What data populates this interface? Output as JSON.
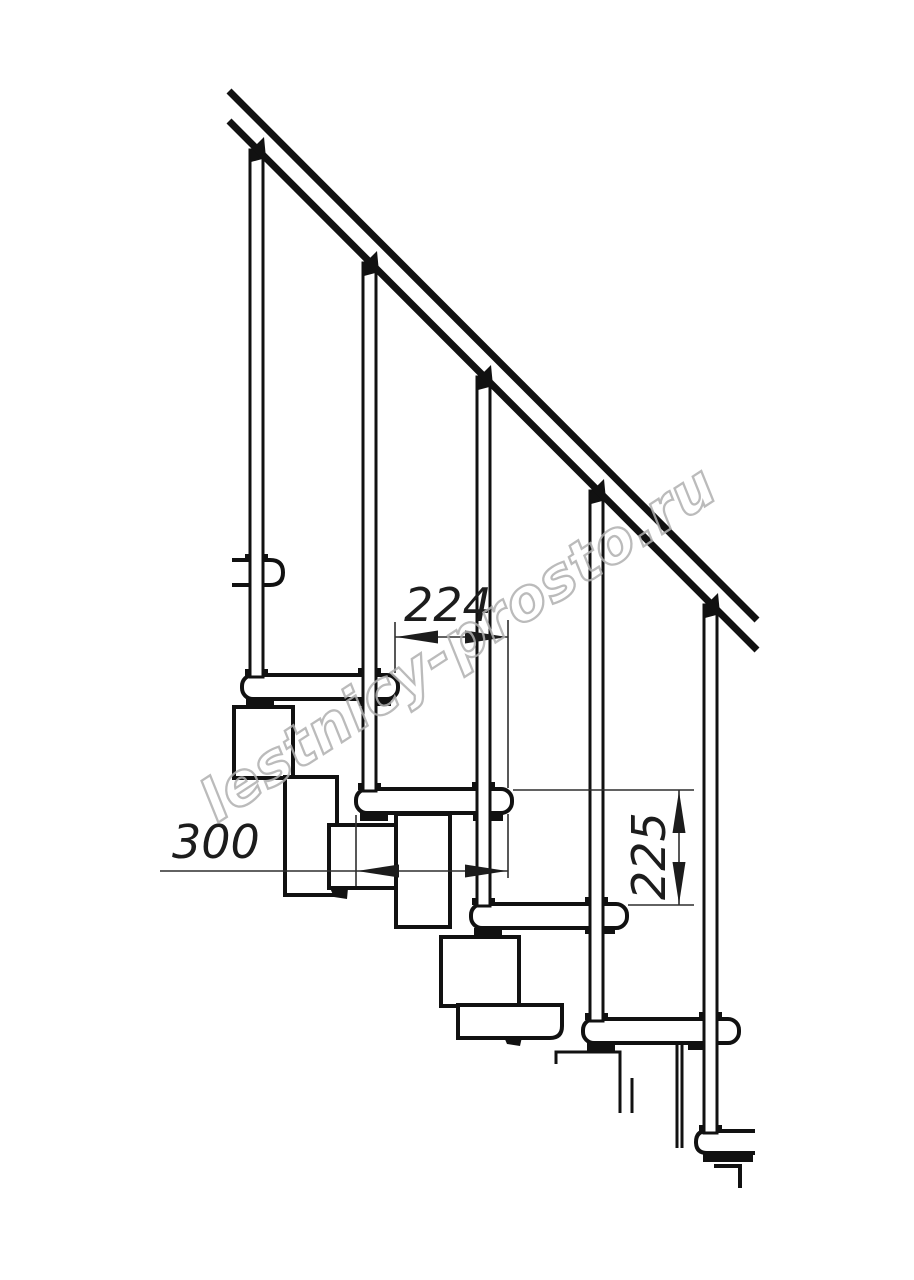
{
  "drawing": {
    "description": "side view technical drawing of a modular staircase with handrail",
    "watermark": {
      "text": "lestnicy-prosto.ru",
      "color": "#b0b0b0"
    },
    "dimension_labels": {
      "horizontal_top": "224",
      "horizontal_left": "300",
      "vertical_right": "225"
    },
    "colors": {
      "background": "#ffffff",
      "line": "#111111",
      "thin_line": "#2e2e2e"
    }
  }
}
